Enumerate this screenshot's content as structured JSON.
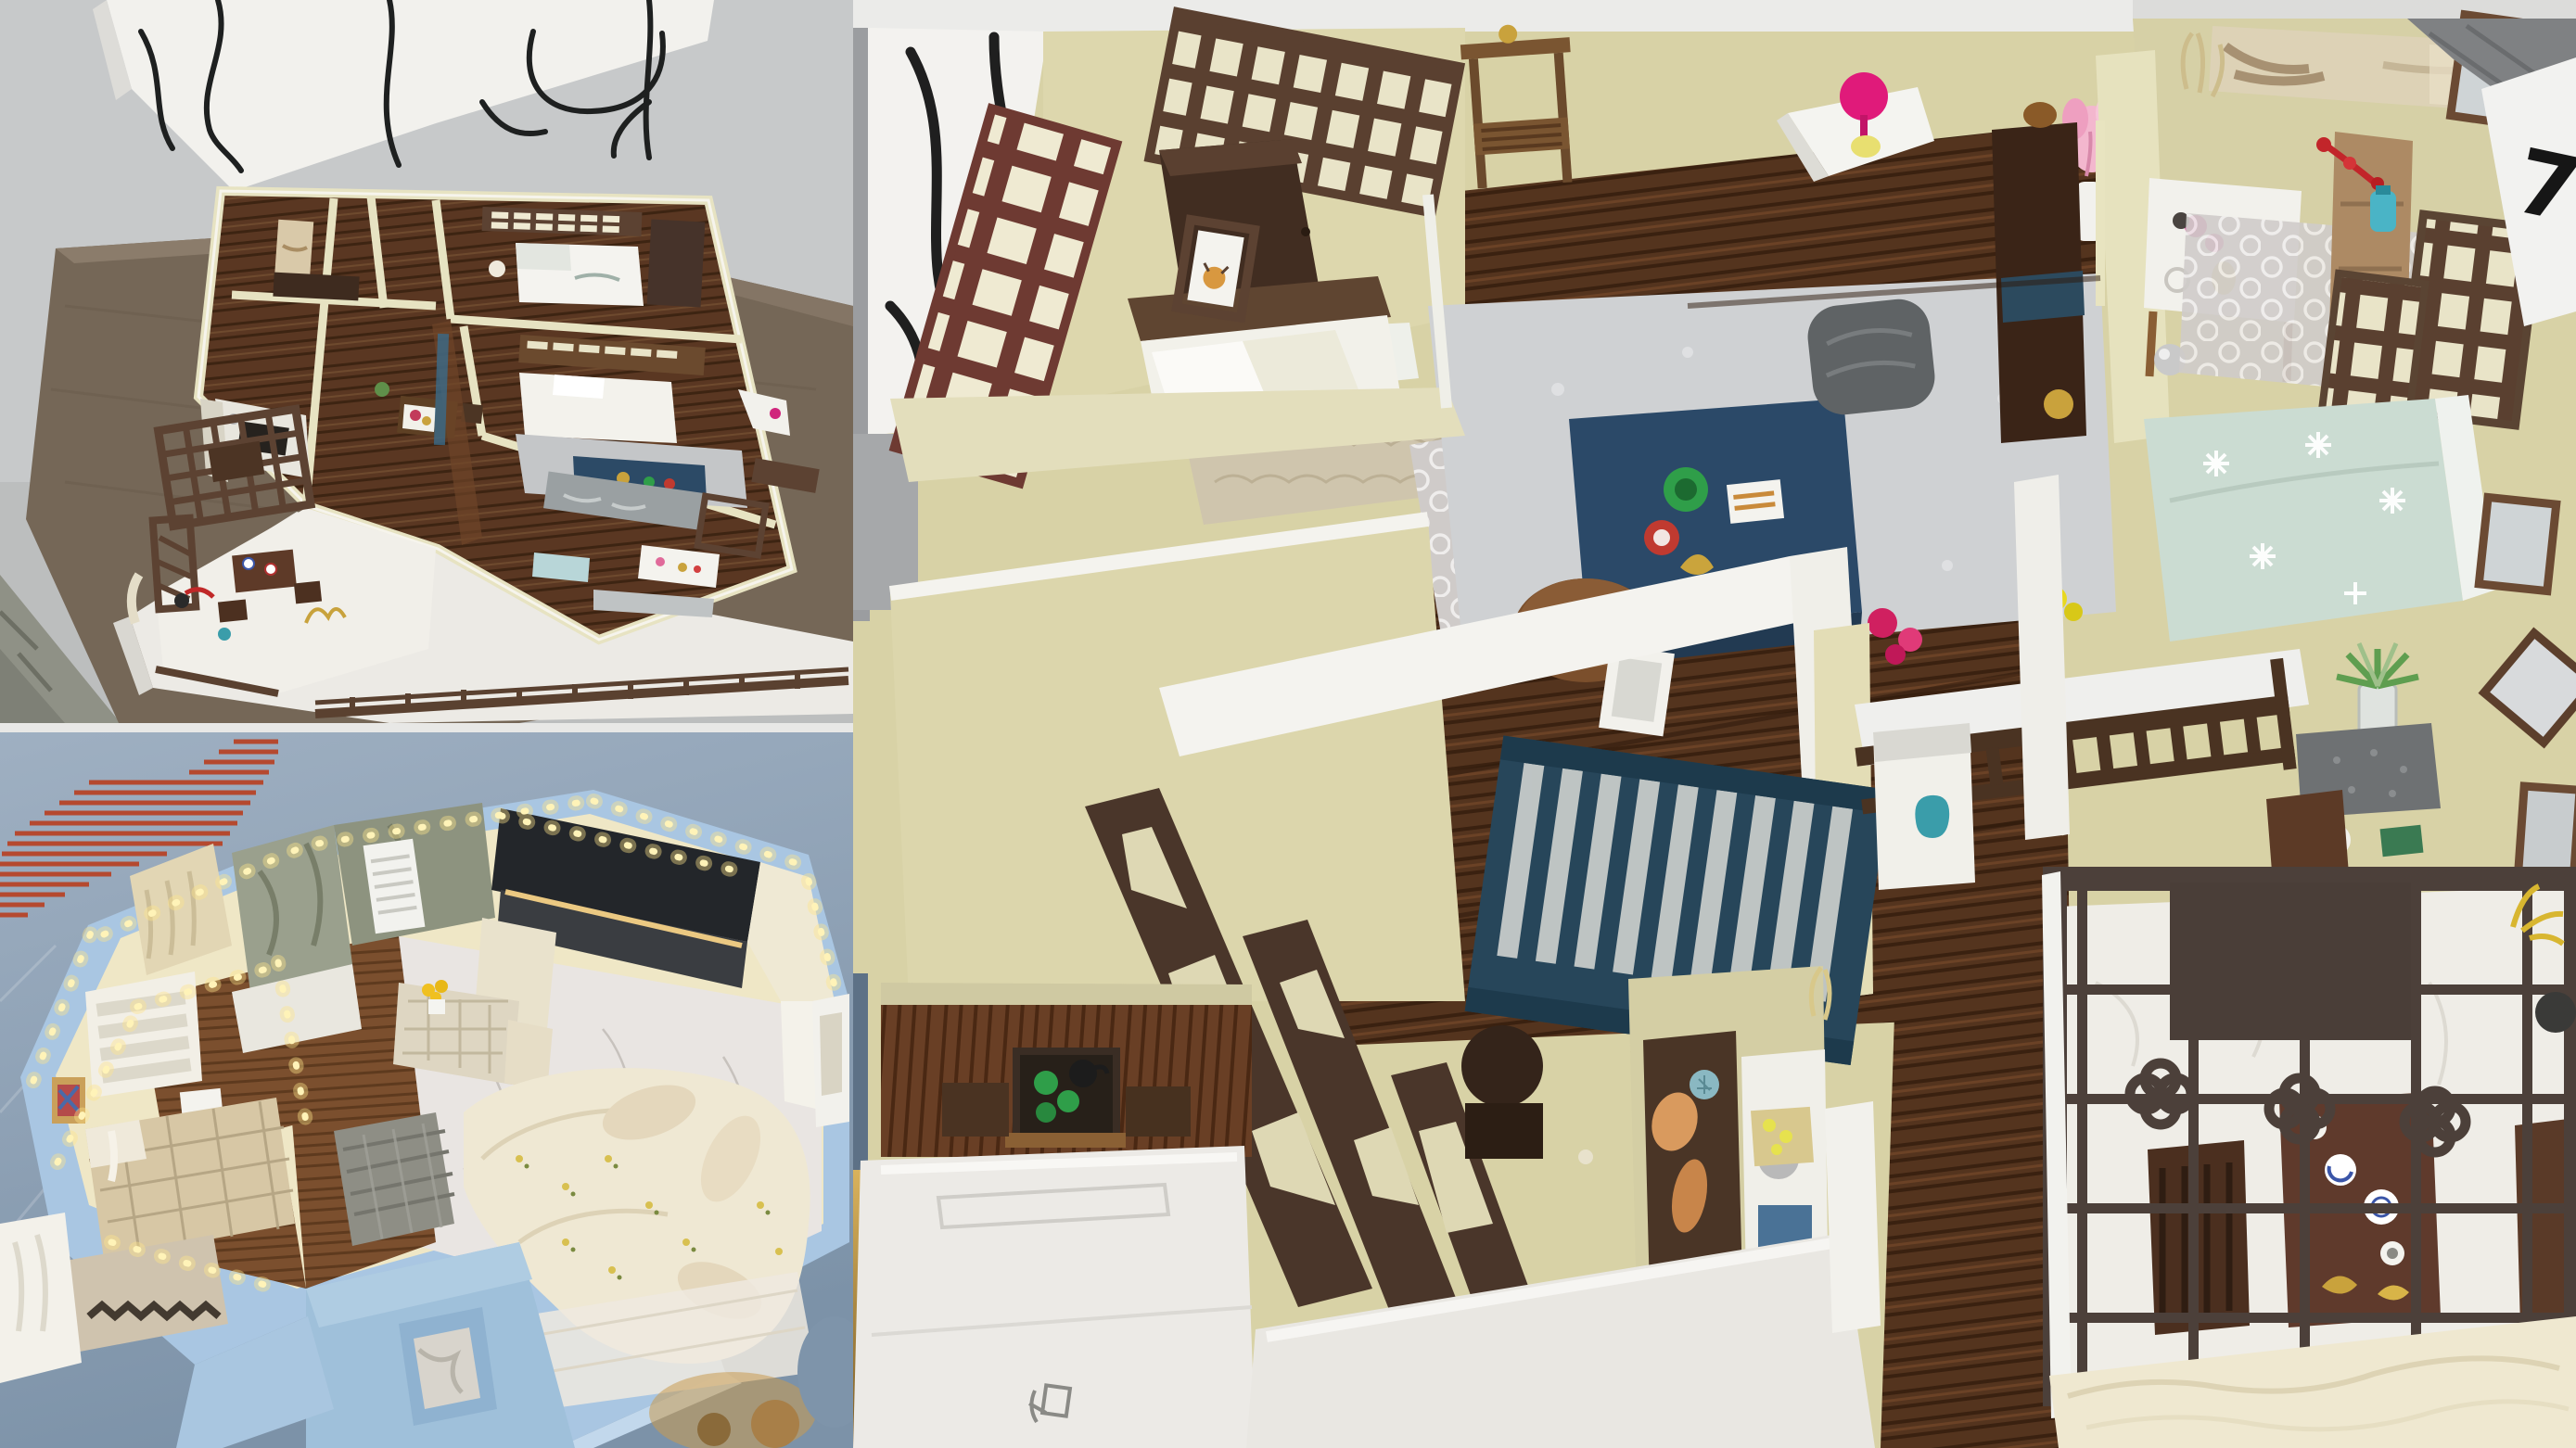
{
  "collage": {
    "description": "Collage of three photographs of handmade miniature apartment interior models",
    "panels": [
      {
        "id": "overview",
        "label": "overhead-photo-of-chinese-style-apartment-model-with-line-art-foam-board"
      },
      {
        "id": "illuminated",
        "label": "photo-of-blue-walled-model-with-warm-string-lights-and-marble-floor"
      },
      {
        "id": "closeup",
        "label": "closeup-photo-of-chinese-style-model-rooms"
      }
    ]
  },
  "marks": {
    "wall_digit": "7"
  },
  "palette": {
    "backdrop_gray": "#c7c9ca",
    "backdrop_blue": "#8da0b4",
    "stripe_red": "#b5492f",
    "table_fabric": "#756757",
    "foam_white": "#eceae5",
    "wall_cream": "#e0dab2",
    "wood_dark": "#54341e",
    "wood_mid": "#6b4226",
    "lattice_brown": "#5a4332",
    "pergola_gray_brown": "#4c403a",
    "crib_navy": "#27465a",
    "coffee_table_navy": "#2b4968",
    "rug_gray": "#cfd1d3",
    "marble_white": "#e9e5e2",
    "powder_blue_wall": "#a9c6e2",
    "led_glow": "#ffeaa0",
    "sofa_cream": "#efe8d3",
    "bed_blue_floral": "#cbdcd2",
    "accent_magenta": "#e01a7a",
    "accent_cyan_vase": "#4ab4c6",
    "accent_red_flower": "#c2252a",
    "accent_green_cup": "#2f9e49",
    "porcelain_blue": "#3a55a8",
    "gold": "#c9a23c"
  },
  "objects": {
    "overview": [
      "line-art-board",
      "display-table",
      "foam-base",
      "courtyard-lattice-screen",
      "tea-table",
      "bedroom-bed",
      "master-bed",
      "gray-rug",
      "navy-mat",
      "kitchen-counter",
      "living-art-panel",
      "perimeter-fence"
    ],
    "illuminated": [
      "red-stripe-poster",
      "string-lights",
      "marble-bathroom",
      "black-kitchen-counter",
      "sunflower-table",
      "plaid-bed",
      "slat-shelf",
      "floral-sofa",
      "woven-bench",
      "window-cutout-wall"
    ],
    "closeup": [
      "line-art-board-edge",
      "lattice-window-panels",
      "wardrobe",
      "bed-with-leaf-pillows",
      "console-table",
      "corner-shelf-pink-fan",
      "pink-flower-vase",
      "shag-rug",
      "navy-coffee-table",
      "gray-pouf",
      "wood-sofa-bench",
      "shower-arm",
      "round-vanity",
      "diagonal-art-panels",
      "navy-crib",
      "rail-daybed",
      "round-back-chairs",
      "landscape-painting",
      "side-table",
      "quatrefoil-rug",
      "tan-cabinet-red-flowers",
      "floral-blue-bed",
      "potted-plant",
      "picture-frames",
      "tea-nook-table",
      "kitchen-nook",
      "white-foam-walls",
      "pencil-sketch-mark",
      "courtyard-pergola",
      "courtyard-tea-set",
      "silk-fabric"
    ]
  }
}
